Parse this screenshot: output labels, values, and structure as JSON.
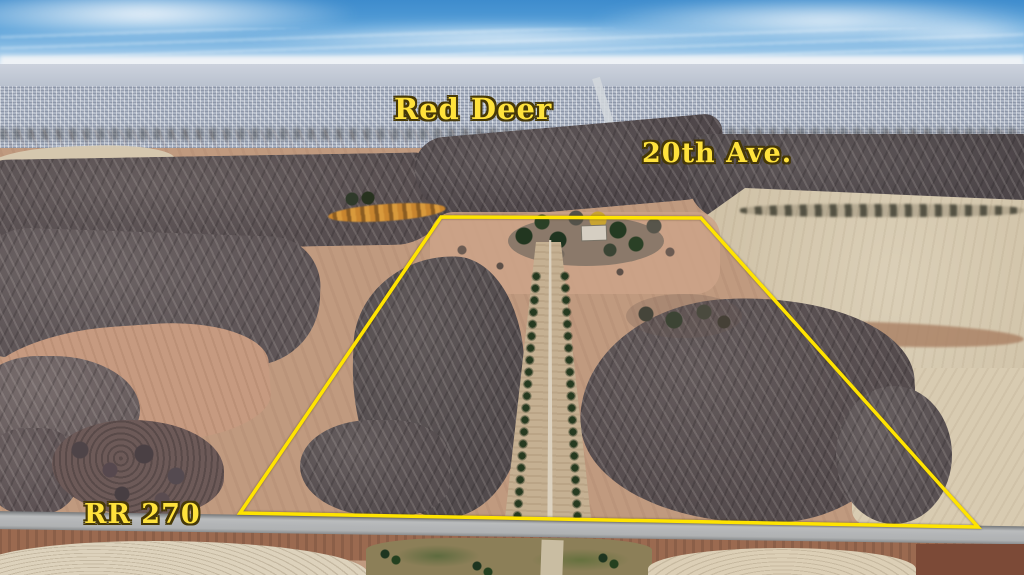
{
  "scene": {
    "type": "aerial-drone-real-estate-photo",
    "description": "Aerial view of a farmland parcel outlined in yellow on the south edge of Red Deer; tilled dark fields, tree-lined central driveway to a farmstead, beige stubble field to the east, city skyline on the horizon under a blue sky."
  },
  "labels": {
    "city": "Red Deer",
    "avenue": "20th Ave.",
    "range_road": "RR 270"
  },
  "boundary": {
    "points": "441,217 701,218 978,527 240,513",
    "stroke": "#ffe400",
    "stroke_width": 3.5
  },
  "palette": {
    "label_yellow": "#ffe23c",
    "label_outline": "#463808",
    "sky_top": "#3e8ccd",
    "sky_horizon": "#eef2f6",
    "city_band": "#a9b2c2",
    "dark_field": "#574e50",
    "pink_field": "#c49a80",
    "tan_field": "#cfc1a6",
    "road_grey": "#b3b5b7",
    "cream_field": "#ddd2bc",
    "tree_green": "#263a20"
  }
}
